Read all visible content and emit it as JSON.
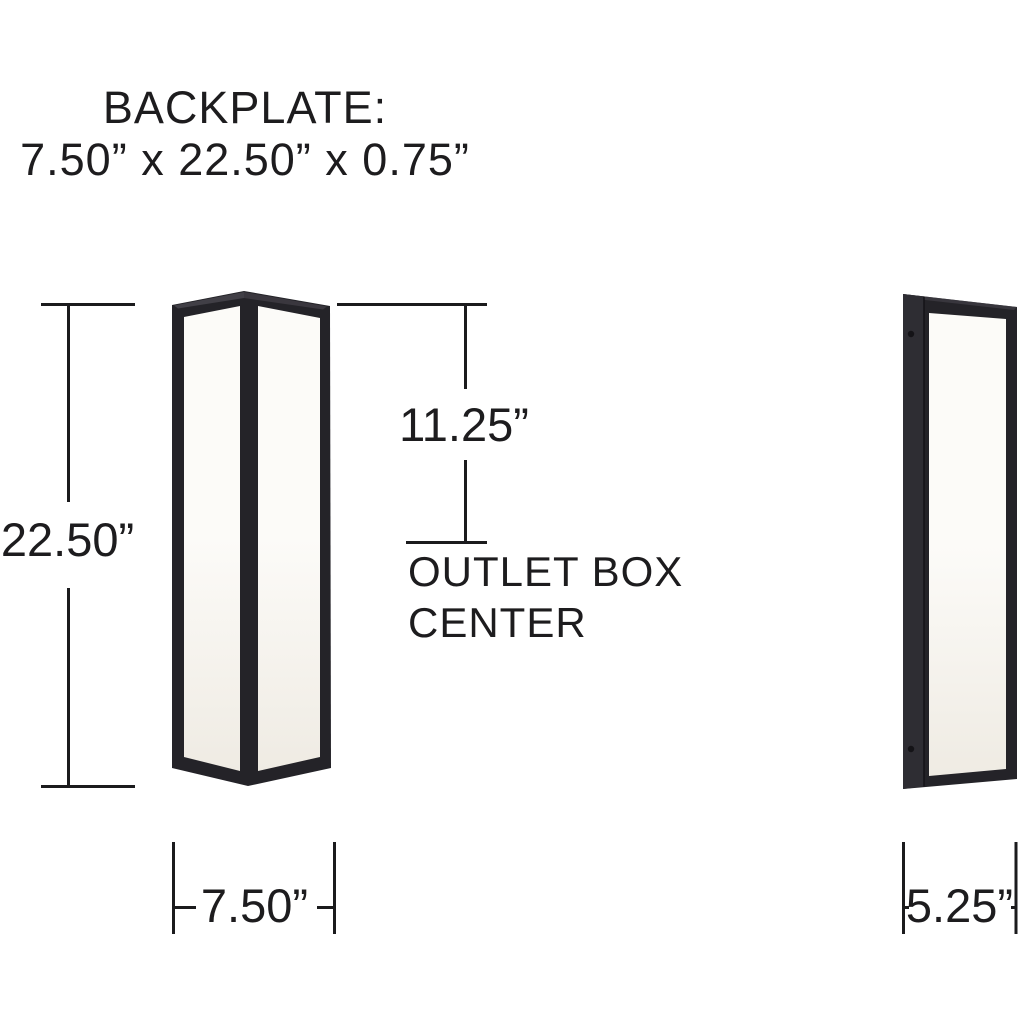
{
  "title": {
    "line1": "BACKPLATE:",
    "line2": "7.50” x 22.50” x 0.75”"
  },
  "dimensions": {
    "height": "22.50”",
    "width": "7.50”",
    "outlet_offset": "11.25”",
    "depth": "5.25”"
  },
  "outlet_caption": {
    "line1": "OUTLET BOX",
    "line2": "CENTER"
  },
  "figures": {
    "front_view": "sconce-front-three-quarter-view",
    "side_view": "sconce-side-view"
  },
  "colors": {
    "background": "#ffffff",
    "text": "#1d1c1e",
    "line": "#1b1b1d",
    "frame": "#242328",
    "frame_top": "#413f46",
    "backplate": "#2e2d33",
    "panel_high": "#fcfbf8",
    "panel_low": "#efebe3",
    "screw": "#141317"
  }
}
